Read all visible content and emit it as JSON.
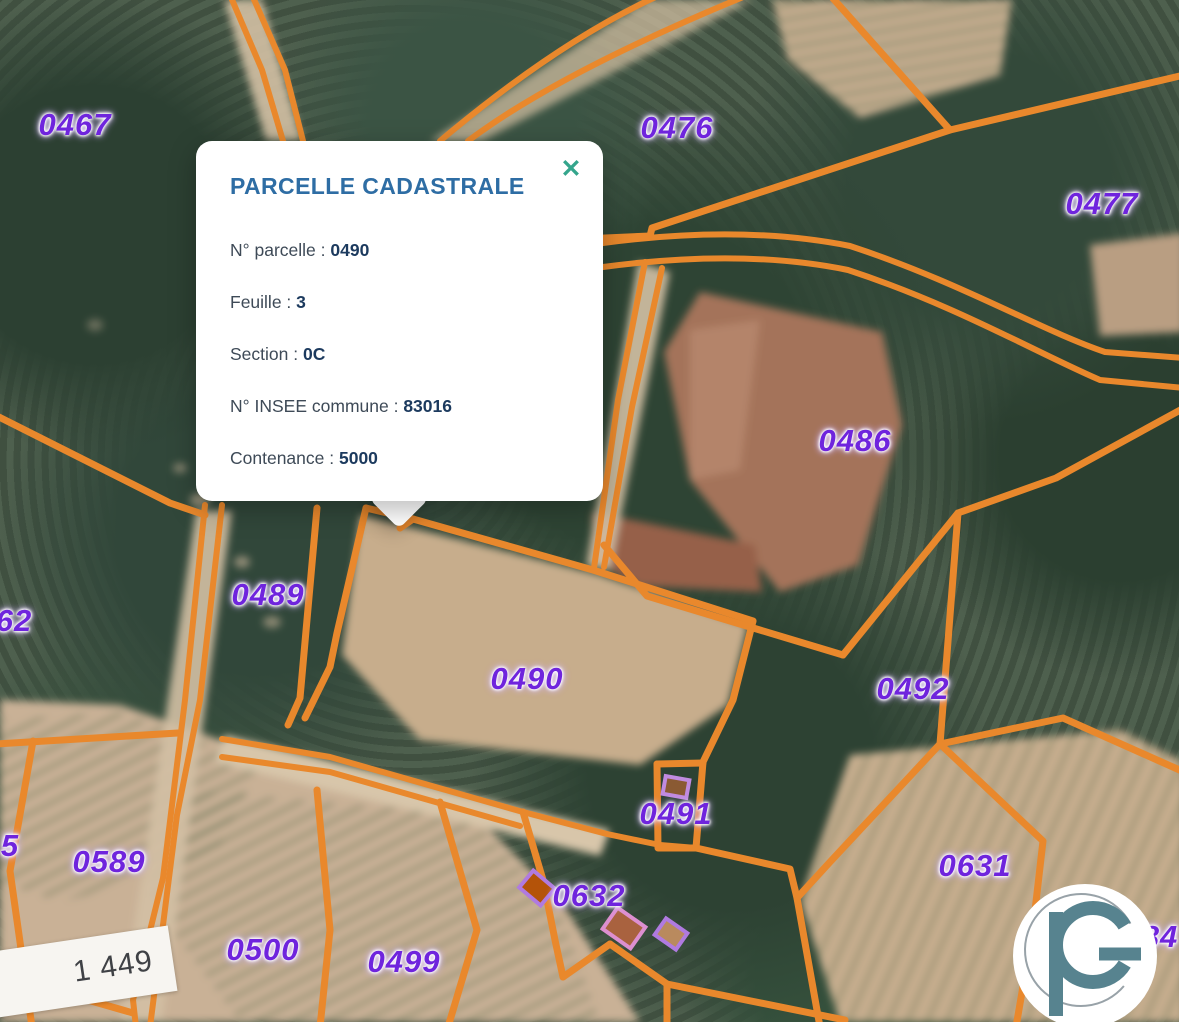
{
  "popup": {
    "title": "PARCELLE CADASTRALE",
    "close_symbol": "✕",
    "separator": " : ",
    "fields": [
      {
        "label": "N° parcelle",
        "value": "0490"
      },
      {
        "label": "Feuille",
        "value": "3"
      },
      {
        "label": "Section",
        "value": "0C"
      },
      {
        "label": "N° INSEE commune",
        "value": "83016"
      },
      {
        "label": "Contenance",
        "value": "5000"
      }
    ]
  },
  "map": {
    "parcel_labels": [
      {
        "text": "0467",
        "x": 75,
        "y": 125
      },
      {
        "text": "0476",
        "x": 677,
        "y": 128
      },
      {
        "text": "0477",
        "x": 1102,
        "y": 204
      },
      {
        "text": "0486",
        "x": 855,
        "y": 441
      },
      {
        "text": "0489",
        "x": 268,
        "y": 595
      },
      {
        "text": "0490",
        "x": 527,
        "y": 679
      },
      {
        "text": "0492",
        "x": 913,
        "y": 689
      },
      {
        "text": "0491",
        "x": 676,
        "y": 814
      },
      {
        "text": "0589",
        "x": 109,
        "y": 862
      },
      {
        "text": "0631",
        "x": 975,
        "y": 866
      },
      {
        "text": "0632",
        "x": 589,
        "y": 896
      },
      {
        "text": "62",
        "x": 14,
        "y": 621
      },
      {
        "text": "5",
        "x": 10,
        "y": 846
      },
      {
        "text": "0500",
        "x": 263,
        "y": 950
      },
      {
        "text": "0499",
        "x": 404,
        "y": 962
      },
      {
        "text": "84",
        "x": 1160,
        "y": 937
      }
    ],
    "scale_label": "1 449"
  },
  "colors": {
    "orange": "#e9882c",
    "label_purple": "#6f24dd",
    "title_blue": "#2e6da4",
    "close_teal": "#34a58c",
    "popup_label": "#3e4a57",
    "popup_value": "#1c3a5e",
    "logo_teal": "#57838f"
  }
}
